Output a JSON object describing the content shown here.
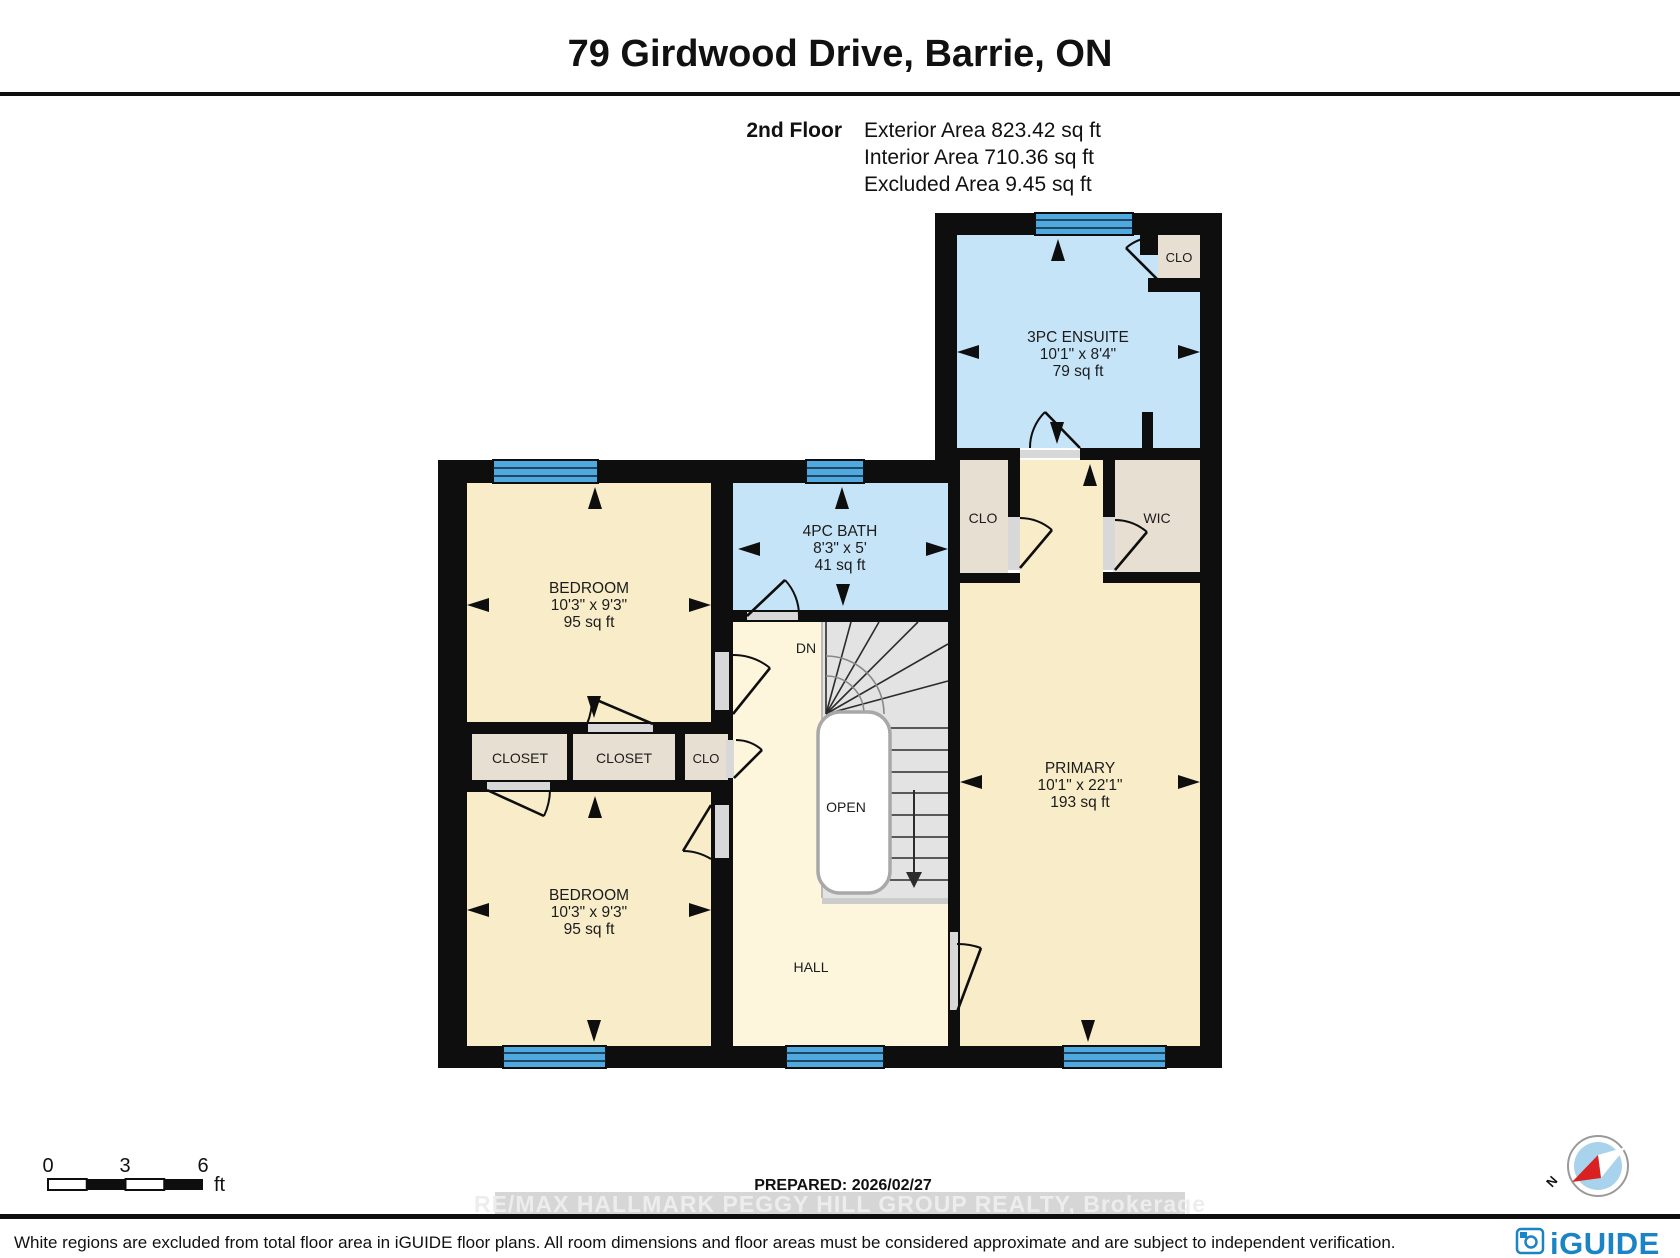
{
  "header": {
    "title": "79 Girdwood Drive, Barrie, ON",
    "floor_label": "2nd Floor",
    "stats": [
      "Exterior Area 823.42 sq ft",
      "Interior Area 710.36 sq ft",
      "Excluded Area 9.45 sq ft"
    ]
  },
  "plan": {
    "rooms": {
      "ensuite": {
        "name": "3PC ENSUITE",
        "dims": "10'1\" x 8'4\"",
        "area": "79 sq ft"
      },
      "bath": {
        "name": "4PC BATH",
        "dims": "8'3\" x 5'",
        "area": "41 sq ft"
      },
      "bedroom_top": {
        "name": "BEDROOM",
        "dims": "10'3\" x 9'3\"",
        "area": "95 sq ft"
      },
      "bedroom_bottom": {
        "name": "BEDROOM",
        "dims": "10'3\" x 9'3\"",
        "area": "95 sq ft"
      },
      "primary": {
        "name": "PRIMARY",
        "dims": "10'1\" x 22'1\"",
        "area": "193 sq ft"
      }
    },
    "labels": {
      "closet1": "CLOSET",
      "closet2": "CLOSET",
      "clo_hall": "CLO",
      "clo_ensuite": "CLO",
      "clo_primary": "CLO",
      "wic": "WIC",
      "hall": "HALL",
      "open": "OPEN",
      "down": "DN"
    }
  },
  "scale_bar": {
    "tick0": "0",
    "tick1": "3",
    "tick2": "6",
    "unit": "ft"
  },
  "footer": {
    "prepared": "PREPARED: 2026/02/27",
    "watermark": "RE/MA X HALLMARK PEGGY HILL GROUP REALTY, Brokerage",
    "disclaimer": "White regions are excluded from total floor area in iGUIDE floor plans. All room dimensions and floor areas must be considered approximate and are subject to independent verification.",
    "brand": "iGUIDE",
    "compass_north": "N"
  },
  "colors": {
    "room_floor": "#f8edc8",
    "hall_floor": "#fdf5dc",
    "bath_floor": "#c6e4f7",
    "closet_floor": "#e7dfd2",
    "window": "#4fa9de",
    "wall": "#0e0e0e",
    "stairs": "#e3e3e3",
    "brand_blue": "#1b84c4",
    "compass_red": "#d92121",
    "compass_blue": "#a9d2ec"
  }
}
